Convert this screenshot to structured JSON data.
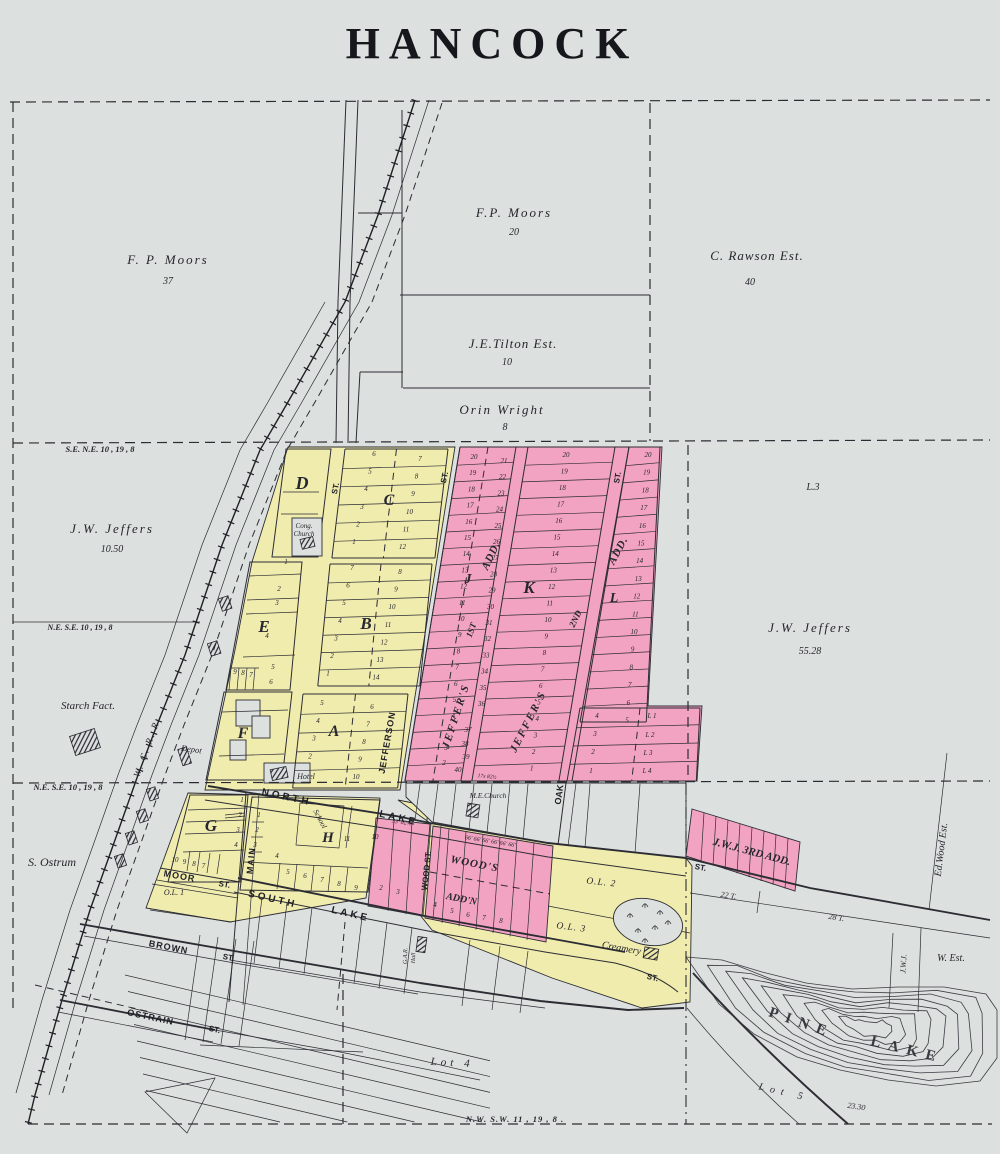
{
  "title": "HANCOCK",
  "colors": {
    "paper": "#dce0de",
    "town_yellow": "#f0ecae",
    "addition_pink": "#f3a3c2",
    "ink": "#26262e"
  },
  "map": {
    "labels": [
      {
        "t": "HANCOCK",
        "x": 492,
        "y": 58,
        "s": 44,
        "c": "title",
        "ls": 9
      },
      {
        "t": "F. P. Moors",
        "x": 168,
        "y": 264,
        "s": 13,
        "ls": 2
      },
      {
        "t": "37",
        "x": 168,
        "y": 284,
        "s": 10
      },
      {
        "t": "F.P. Moors",
        "x": 514,
        "y": 217,
        "s": 13,
        "ls": 2
      },
      {
        "t": "20",
        "x": 514,
        "y": 235,
        "s": 10
      },
      {
        "t": "C. Rawson Est.",
        "x": 757,
        "y": 260,
        "s": 13,
        "ls": 1
      },
      {
        "t": "40",
        "x": 750,
        "y": 285,
        "s": 10
      },
      {
        "t": "J.E.Tilton Est.",
        "x": 513,
        "y": 348,
        "s": 13,
        "ls": 1
      },
      {
        "t": "10",
        "x": 507,
        "y": 365,
        "s": 10
      },
      {
        "t": "Orin Wright",
        "x": 502,
        "y": 414,
        "s": 13,
        "ls": 2
      },
      {
        "t": "8",
        "x": 505,
        "y": 430,
        "s": 10
      },
      {
        "t": "J.W. Jeffers",
        "x": 112,
        "y": 533,
        "s": 13,
        "ls": 2
      },
      {
        "t": "10.50",
        "x": 112,
        "y": 552,
        "s": 10
      },
      {
        "t": "L.3",
        "x": 813,
        "y": 490,
        "s": 10
      },
      {
        "t": "J.W. Jeffers",
        "x": 810,
        "y": 632,
        "s": 13,
        "ls": 2
      },
      {
        "t": "55.28",
        "x": 810,
        "y": 654,
        "s": 10
      },
      {
        "t": "S. Ostrum",
        "x": 52,
        "y": 866,
        "s": 12
      },
      {
        "t": "Starch Fact.",
        "x": 88,
        "y": 709,
        "s": 11
      },
      {
        "t": "Lot 4",
        "x": 452,
        "y": 1066,
        "s": 11,
        "ls": 4,
        "r": 3
      },
      {
        "t": "Lot 5",
        "x": 783,
        "y": 1095,
        "s": 10,
        "ls": 6,
        "r": 13
      },
      {
        "t": "23.30",
        "x": 856,
        "y": 1109,
        "s": 8,
        "r": 8
      },
      {
        "t": "PINE",
        "x": 800,
        "y": 1027,
        "s": 15,
        "ls": 8,
        "r": 19,
        "c": "pine"
      },
      {
        "t": "LAKE",
        "x": 906,
        "y": 1054,
        "s": 15,
        "ls": 8,
        "r": 14,
        "c": "pine"
      },
      {
        "t": "S.E.  N.E.  10 , 19 ,  8",
        "x": 100,
        "y": 452,
        "s": 8.5,
        "c": "sec"
      },
      {
        "t": "N.E. S.E. 10 , 19 ,  8",
        "x": 80,
        "y": 630,
        "s": 8,
        "c": "sec"
      },
      {
        "t": "N.E. S.E. 10 , 19 ,  8",
        "x": 68,
        "y": 790,
        "s": 8.5,
        "c": "sec"
      },
      {
        "t": "N.W.  S.W.  11 ,  19 ,  8 .",
        "x": 515,
        "y": 1122,
        "s": 8.5,
        "c": "sec",
        "ls": 1
      },
      {
        "t": "ST.",
        "x": 338,
        "y": 489,
        "s": 8,
        "r": -78,
        "c": "st"
      },
      {
        "t": "JEFFERSON",
        "x": 390,
        "y": 743,
        "s": 9,
        "r": -80,
        "c": "st",
        "ls": 1
      },
      {
        "t": "ST.",
        "x": 447,
        "y": 478,
        "s": 8,
        "r": -78,
        "c": "st"
      },
      {
        "t": "OAK",
        "x": 562,
        "y": 795,
        "s": 9,
        "r": -82,
        "c": "st"
      },
      {
        "t": "ST.",
        "x": 620,
        "y": 478,
        "s": 8,
        "r": -80,
        "c": "st"
      },
      {
        "t": "NORTH",
        "x": 286,
        "y": 800,
        "s": 10,
        "r": 12,
        "c": "st",
        "ls": 3
      },
      {
        "t": "LAKE",
        "x": 398,
        "y": 821,
        "s": 10,
        "r": 13,
        "c": "st",
        "ls": 3
      },
      {
        "t": "SOUTH",
        "x": 272,
        "y": 902,
        "s": 10,
        "r": 13,
        "c": "st",
        "ls": 3
      },
      {
        "t": "LAKE",
        "x": 350,
        "y": 917,
        "s": 10,
        "r": 13,
        "c": "st",
        "ls": 3
      },
      {
        "t": "MAIN",
        "x": 254,
        "y": 861,
        "s": 9,
        "r": -84,
        "c": "st",
        "ls": 1
      },
      {
        "t": "MOOR",
        "x": 179,
        "y": 879,
        "s": 9,
        "r": 10,
        "c": "st",
        "ls": 1
      },
      {
        "t": "ST.",
        "x": 224,
        "y": 887,
        "s": 8,
        "r": 10,
        "c": "st"
      },
      {
        "t": "BROWN",
        "x": 168,
        "y": 950,
        "s": 9,
        "r": 11,
        "c": "st",
        "ls": 1
      },
      {
        "t": "ST.",
        "x": 228,
        "y": 960,
        "s": 8,
        "r": 11,
        "c": "st"
      },
      {
        "t": "OSTRAIN",
        "x": 150,
        "y": 1020,
        "s": 9,
        "r": 12,
        "c": "st",
        "ls": 1
      },
      {
        "t": "ST.",
        "x": 214,
        "y": 1032,
        "s": 8,
        "r": 12,
        "c": "st"
      },
      {
        "t": "WOOD ST.",
        "x": 429,
        "y": 871,
        "s": 8,
        "r": -84,
        "c": "st"
      },
      {
        "t": "ST.",
        "x": 700,
        "y": 870,
        "s": 8,
        "r": 11,
        "c": "st"
      },
      {
        "t": "ST.",
        "x": 652,
        "y": 980,
        "s": 8,
        "r": 14,
        "c": "st"
      },
      {
        "t": "W. C. R. R.",
        "x": 150,
        "y": 748,
        "s": 9.5,
        "r": -70,
        "ls": 2
      },
      {
        "t": "O.L. 1",
        "x": 174,
        "y": 895,
        "s": 8
      },
      {
        "t": "O.L. 2",
        "x": 601,
        "y": 885,
        "s": 9.5,
        "r": 6,
        "ls": 1
      },
      {
        "t": "O.L. 3",
        "x": 571,
        "y": 930,
        "s": 9.5,
        "r": 7,
        "ls": 1
      },
      {
        "t": "22 T.",
        "x": 728,
        "y": 898,
        "s": 8,
        "r": 9
      },
      {
        "t": "28 T.",
        "x": 836,
        "y": 920,
        "s": 8,
        "r": 9
      },
      {
        "t": "Creamery",
        "x": 621,
        "y": 951,
        "s": 10,
        "r": 10
      },
      {
        "t": "Ed.Wood Est.",
        "x": 944,
        "y": 850,
        "s": 10,
        "r": -83
      },
      {
        "t": "J.W.J.",
        "x": 906,
        "y": 964,
        "s": 8,
        "r": -87
      },
      {
        "t": "W. Est.",
        "x": 951,
        "y": 961,
        "s": 10
      },
      {
        "t": "Cong.",
        "x": 304,
        "y": 528,
        "s": 7
      },
      {
        "t": "Church",
        "x": 304,
        "y": 536,
        "s": 7
      },
      {
        "t": "M.E.Church",
        "x": 488,
        "y": 798,
        "s": 7.5
      },
      {
        "t": "School",
        "x": 318,
        "y": 820,
        "s": 7.5,
        "r": 62
      },
      {
        "t": "Hotel",
        "x": 306,
        "y": 779,
        "s": 8
      },
      {
        "t": "Depot",
        "x": 191,
        "y": 752,
        "s": 8.5,
        "r": 8
      },
      {
        "t": "G.A.R.",
        "x": 407,
        "y": 956,
        "s": 6,
        "r": -88
      },
      {
        "t": "Hall",
        "x": 415,
        "y": 958,
        "s": 6,
        "r": -88
      },
      {
        "t": "J.W.J. 3RD ADD.",
        "x": 751,
        "y": 855,
        "s": 11,
        "r": 15,
        "c": "add"
      },
      {
        "t": "WOOD'S",
        "x": 474,
        "y": 867,
        "s": 11,
        "r": 11,
        "c": "add",
        "ls": 1
      },
      {
        "t": "ADD'N",
        "x": 461,
        "y": 902,
        "s": 10,
        "r": 11,
        "c": "add"
      },
      {
        "t": "JEFFER'S",
        "x": 459,
        "y": 717,
        "s": 11,
        "r": -72,
        "c": "add",
        "ls": 2
      },
      {
        "t": "1ST",
        "x": 474,
        "y": 631,
        "s": 9,
        "r": -70,
        "c": "add"
      },
      {
        "t": "ADD.",
        "x": 494,
        "y": 557,
        "s": 11,
        "r": -65,
        "c": "add",
        "ls": 1
      },
      {
        "t": "JEFFER'S",
        "x": 531,
        "y": 723,
        "s": 11,
        "r": -63,
        "c": "add",
        "ls": 2
      },
      {
        "t": "2ND",
        "x": 578,
        "y": 620,
        "s": 9,
        "r": -64,
        "c": "add"
      },
      {
        "t": "ADD.",
        "x": 621,
        "y": 552,
        "s": 11,
        "r": -62,
        "c": "add",
        "ls": 1
      },
      {
        "t": "33' 82½'",
        "x": 402,
        "y": 824,
        "s": 6,
        "r": 8,
        "c": "tiny"
      },
      {
        "t": "66' 66' 66' 66' 66' 66'",
        "x": 490,
        "y": 843,
        "s": 6,
        "r": 9,
        "c": "tiny"
      },
      {
        "t": "17x  82½",
        "x": 487,
        "y": 778,
        "s": 5.5,
        "r": 5,
        "c": "tiny"
      },
      {
        "t": "D",
        "x": 302,
        "y": 489,
        "s": 18,
        "c": "blk"
      },
      {
        "t": "C",
        "x": 389,
        "y": 505,
        "s": 16,
        "c": "blk"
      },
      {
        "t": "E",
        "x": 264,
        "y": 632,
        "s": 17,
        "c": "blk"
      },
      {
        "t": "B",
        "x": 366,
        "y": 629,
        "s": 17,
        "c": "blk"
      },
      {
        "t": "A",
        "x": 334,
        "y": 736,
        "s": 16,
        "c": "blk"
      },
      {
        "t": "F",
        "x": 243,
        "y": 738,
        "s": 16,
        "c": "blk"
      },
      {
        "t": "G",
        "x": 211,
        "y": 831,
        "s": 17,
        "c": "blk"
      },
      {
        "t": "H",
        "x": 328,
        "y": 842,
        "s": 15,
        "c": "blk"
      },
      {
        "t": "J",
        "x": 468,
        "y": 583,
        "s": 14,
        "c": "blk"
      },
      {
        "t": "K",
        "x": 529,
        "y": 593,
        "s": 17,
        "c": "blk"
      },
      {
        "t": "L",
        "x": 614,
        "y": 602,
        "s": 14,
        "c": "blk"
      }
    ],
    "lot_grids": [
      {
        "x": 374,
        "y": 456,
        "dx": -4,
        "dy": 17.6,
        "v": [
          "6",
          "5",
          "4",
          "3",
          "2",
          "1"
        ]
      },
      {
        "x": 420,
        "y": 461,
        "dx": -3.5,
        "dy": 17.6,
        "v": [
          "7",
          "8",
          "9",
          "10",
          "11",
          "12"
        ]
      },
      {
        "x": 352,
        "y": 570,
        "dx": -4,
        "dy": 17.6,
        "v": [
          "7",
          "6",
          "5",
          "4",
          "3",
          "2",
          "1"
        ]
      },
      {
        "x": 400,
        "y": 574,
        "dx": -4,
        "dy": 17.6,
        "v": [
          "8",
          "9",
          "10",
          "11",
          "12",
          "13",
          "14"
        ]
      },
      {
        "x": 322,
        "y": 705,
        "dx": -4,
        "dy": 17.8,
        "v": [
          "5",
          "4",
          "3",
          "2"
        ]
      },
      {
        "x": 372,
        "y": 709,
        "dx": -4,
        "dy": 17.5,
        "v": [
          "6",
          "7",
          "8",
          "9",
          "10"
        ]
      },
      {
        "x": 242,
        "y": 802,
        "dx": -2,
        "dy": 15,
        "v": [
          "1",
          "2",
          "3",
          "4"
        ]
      },
      {
        "x": 175,
        "y": 862,
        "dx": 9.5,
        "dy": 2,
        "v": [
          "10",
          "9",
          "8",
          "7"
        ]
      },
      {
        "x": 288,
        "y": 874,
        "dx": 17,
        "dy": 4,
        "v": [
          "5",
          "6",
          "7",
          "8",
          "9"
        ]
      },
      {
        "x": 474,
        "y": 459,
        "dx": -1.3,
        "dy": 16.2,
        "v": [
          "20",
          "19",
          "18",
          "17",
          "16",
          "15",
          "14",
          "13",
          "12",
          "11",
          "10",
          "9",
          "8",
          "7",
          "6",
          "5",
          "4"
        ]
      },
      {
        "x": 504,
        "y": 463,
        "dx": -1.5,
        "dy": 16.2,
        "v": [
          "21",
          "22",
          "23",
          "24",
          "25",
          "26",
          "27",
          "28",
          "29",
          "30",
          "31",
          "32",
          "33",
          "34",
          "35",
          "36"
        ]
      },
      {
        "x": 566,
        "y": 457,
        "dx": -1.8,
        "dy": 16.5,
        "v": [
          "20",
          "19",
          "18",
          "17",
          "16",
          "15",
          "14",
          "13",
          "12",
          "11",
          "10",
          "9",
          "8",
          "7",
          "6",
          "5",
          "4",
          "3",
          "2",
          "1"
        ]
      },
      {
        "x": 648,
        "y": 457,
        "dx": -1.4,
        "dy": 17.7,
        "v": [
          "20",
          "19",
          "18",
          "17",
          "16",
          "15",
          "14",
          "13",
          "12",
          "11",
          "10",
          "9",
          "8",
          "7",
          "6",
          "5"
        ]
      }
    ],
    "lot_points": [
      {
        "t": "1",
        "x": 286,
        "y": 564
      },
      {
        "t": "2",
        "x": 279,
        "y": 591
      },
      {
        "t": "3",
        "x": 277,
        "y": 605
      },
      {
        "t": "4",
        "x": 267,
        "y": 638
      },
      {
        "t": "5",
        "x": 273,
        "y": 669
      },
      {
        "t": "6",
        "x": 271,
        "y": 684
      },
      {
        "t": "9",
        "x": 235,
        "y": 674
      },
      {
        "t": "8",
        "x": 243,
        "y": 675
      },
      {
        "t": "7",
        "x": 251,
        "y": 677
      },
      {
        "t": "11",
        "x": 347,
        "y": 841
      },
      {
        "t": "10",
        "x": 375,
        "y": 839
      },
      {
        "t": "4",
        "x": 277,
        "y": 858
      },
      {
        "t": "1",
        "x": 259,
        "y": 817
      },
      {
        "t": "2",
        "x": 257,
        "y": 832
      },
      {
        "t": "3",
        "x": 255,
        "y": 847
      },
      {
        "t": "37",
        "x": 468,
        "y": 732
      },
      {
        "t": "38",
        "x": 465,
        "y": 746
      },
      {
        "t": "39",
        "x": 466,
        "y": 759
      },
      {
        "t": "40",
        "x": 458,
        "y": 772
      },
      {
        "t": "3",
        "x": 446,
        "y": 750
      },
      {
        "t": "2",
        "x": 444,
        "y": 765
      },
      {
        "t": "4",
        "x": 597,
        "y": 718
      },
      {
        "t": "3",
        "x": 595,
        "y": 736
      },
      {
        "t": "2",
        "x": 593,
        "y": 754
      },
      {
        "t": "1",
        "x": 591,
        "y": 773
      },
      {
        "t": "L 1",
        "x": 652,
        "y": 718
      },
      {
        "t": "L 2",
        "x": 650,
        "y": 737
      },
      {
        "t": "L 3",
        "x": 648,
        "y": 755
      },
      {
        "t": "L 4",
        "x": 647,
        "y": 773
      },
      {
        "t": "2",
        "x": 381,
        "y": 890
      },
      {
        "t": "3",
        "x": 398,
        "y": 894
      },
      {
        "t": "4",
        "x": 435,
        "y": 907
      },
      {
        "t": "5",
        "x": 452,
        "y": 913
      },
      {
        "t": "6",
        "x": 468,
        "y": 917
      },
      {
        "t": "7",
        "x": 484,
        "y": 920
      },
      {
        "t": "8",
        "x": 501,
        "y": 923
      }
    ]
  }
}
